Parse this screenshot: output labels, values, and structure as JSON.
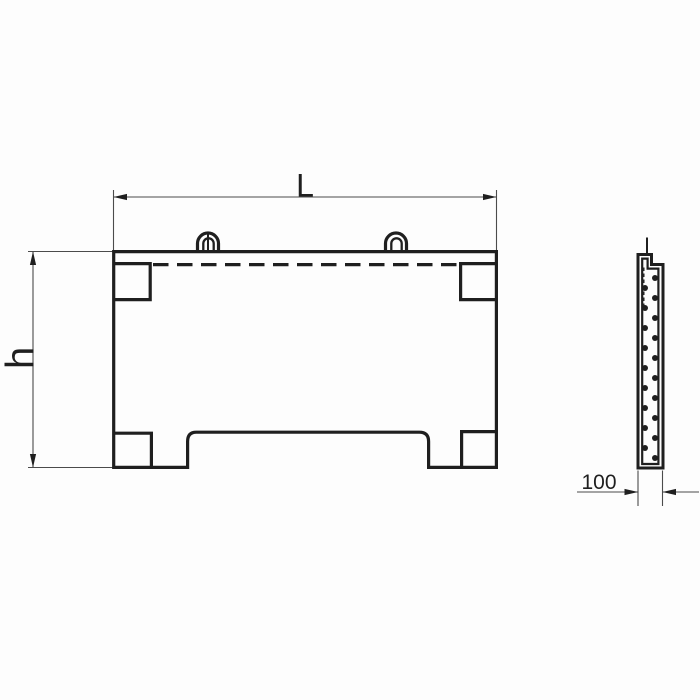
{
  "drawing": {
    "background_color": "#fdfdfd",
    "line_color": "#1f1f1f",
    "thin_line_color": "#4b4b4b",
    "dimensions": {
      "length": {
        "label": "L"
      },
      "height": {
        "label": "h"
      },
      "thickness": {
        "label": "100"
      }
    }
  }
}
